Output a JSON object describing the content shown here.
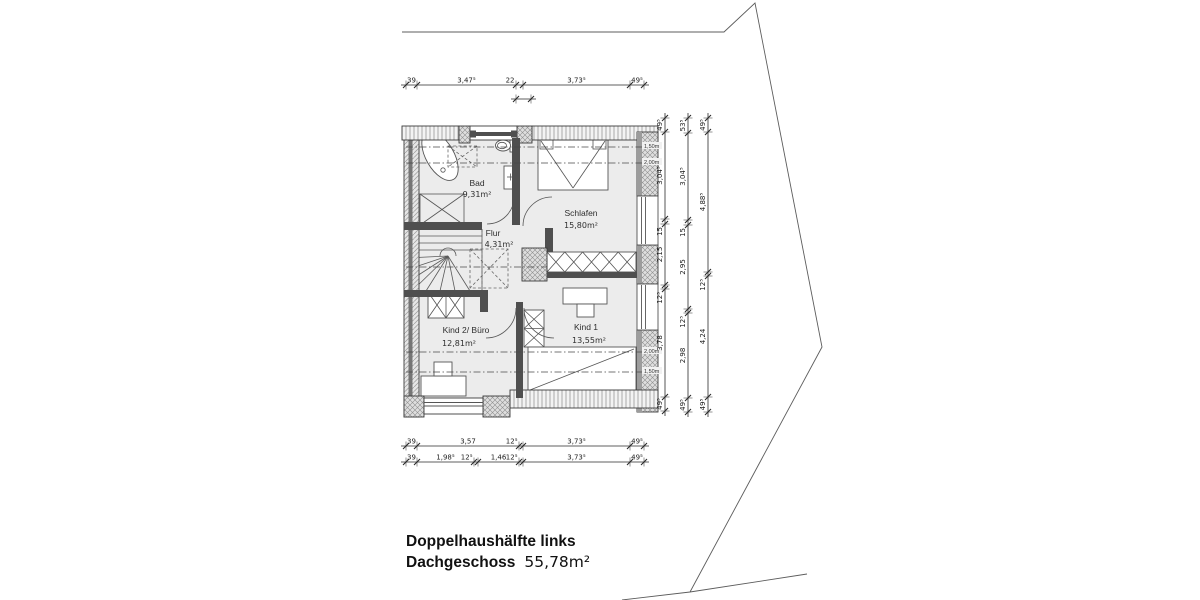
{
  "title": {
    "line1": "Doppelhaushälfte links",
    "line2_name": "Dachgeschoss",
    "line2_area": "55,78m²"
  },
  "rooms": [
    {
      "name": "Bad",
      "area": "9,31m²"
    },
    {
      "name": "Schlafen",
      "area": "15,80m²"
    },
    {
      "name": "Flur",
      "area": "4,31m²"
    },
    {
      "name": "Kind 2/ Büro",
      "area": "12,81m²"
    },
    {
      "name": "Kind 1",
      "area": "13,55m²"
    }
  ],
  "height_labels": [
    {
      "text": "1,50m",
      "x": 644,
      "y": 147
    },
    {
      "text": "2,00m",
      "x": 644,
      "y": 163
    },
    {
      "text": "2,00m",
      "x": 644,
      "y": 352
    },
    {
      "text": "1,50m",
      "x": 644,
      "y": 372
    }
  ],
  "dimensions": {
    "chains": [
      {
        "id": "top",
        "dir": "h",
        "y": 85,
        "ticks": [
          406,
          417,
          516,
          523,
          630,
          644
        ],
        "labels": [
          "39",
          "3,47⁵",
          "22",
          "3,73⁵",
          "49⁵"
        ]
      },
      {
        "id": "top-sub",
        "dir": "h",
        "y": 99,
        "ticks": [
          516,
          531
        ],
        "labels": [
          ""
        ]
      },
      {
        "id": "bottom-1",
        "dir": "h",
        "y": 446,
        "ticks": [
          406,
          417,
          519,
          523,
          630,
          644
        ],
        "labels": [
          "39",
          "3,57",
          "12⁵",
          "3,73⁵",
          "49⁵"
        ]
      },
      {
        "id": "bottom-2",
        "dir": "h",
        "y": 462,
        "ticks": [
          406,
          417,
          474,
          478,
          519,
          523,
          630,
          644
        ],
        "labels": [
          "39",
          "1,98⁵",
          "12⁵",
          "1,46",
          "12⁵",
          "3,73⁵",
          "49⁵"
        ]
      },
      {
        "id": "right-1",
        "dir": "v",
        "x": 665,
        "ticks": [
          118,
          132,
          219,
          224,
          285,
          289,
          397,
          411
        ],
        "labels": [
          "49⁵",
          "3,04⁵",
          "15",
          "2,15",
          "12⁵",
          "3,78",
          "49⁵"
        ]
      },
      {
        "id": "right-2",
        "dir": "v",
        "x": 688,
        "ticks": [
          118,
          133,
          220,
          225,
          309,
          313,
          398,
          412
        ],
        "labels": [
          "53⁵",
          "3,04⁵",
          "15",
          "2,95",
          "12⁵",
          "2,98",
          "49⁵"
        ]
      },
      {
        "id": "right-3",
        "dir": "v",
        "x": 708,
        "ticks": [
          118,
          132,
          272,
          276,
          397,
          412
        ],
        "labels": [
          "49⁵",
          "4,88⁵",
          "12⁵",
          "4,24",
          "49⁵"
        ]
      }
    ]
  },
  "colors": {
    "background": "#ffffff",
    "room_fill": "#ececec",
    "wall_dark": "#4f4f4f",
    "hatch_gray": "#8f8f8f",
    "line": "#3c3c3c"
  }
}
